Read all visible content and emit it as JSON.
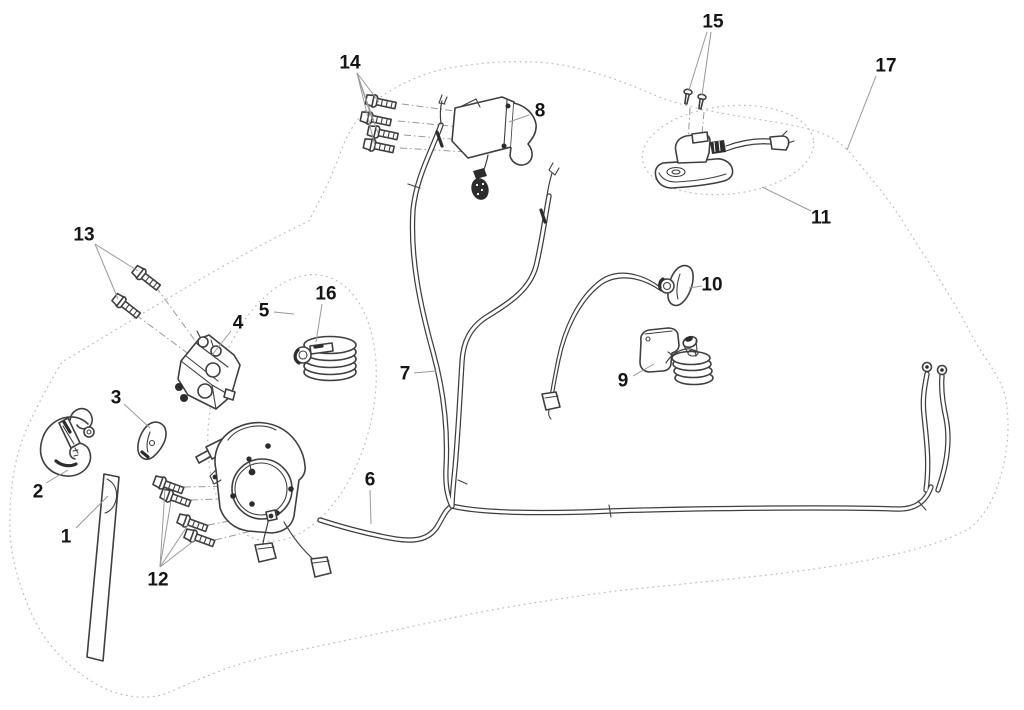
{
  "diagram": {
    "background_color": "#ffffff",
    "line_color": "#3f3f3f",
    "leader_color": "#999999",
    "boundary_color": "#bdbdbd",
    "label_color": "#151515"
  },
  "callouts": [
    {
      "num": "1",
      "part": "strap",
      "x": 66,
      "y": 536,
      "leaders": [
        [
          76,
          528,
          108,
          496
        ]
      ]
    },
    {
      "num": "2",
      "part": "hook",
      "x": 38,
      "y": 491,
      "leaders": [
        [
          46,
          483,
          68,
          470
        ]
      ]
    },
    {
      "num": "3",
      "part": "clip",
      "x": 116,
      "y": 397,
      "leaders": [
        [
          124,
          404,
          150,
          428
        ]
      ]
    },
    {
      "num": "4",
      "part": "relay-box",
      "x": 238,
      "y": 322,
      "leaders": [
        [
          231,
          331,
          212,
          355
        ]
      ]
    },
    {
      "num": "5",
      "part": "coil-group",
      "x": 264,
      "y": 310,
      "leaders": [
        [
          274,
          312,
          294,
          314
        ]
      ]
    },
    {
      "num": "6",
      "part": "wiring-harness",
      "x": 370,
      "y": 479,
      "leaders": [
        [
          370,
          490,
          371,
          524
        ]
      ]
    },
    {
      "num": "7",
      "part": "power-cables",
      "x": 405,
      "y": 373,
      "leaders": [
        [
          414,
          373,
          436,
          371
        ]
      ]
    },
    {
      "num": "8",
      "part": "contactor-switch",
      "x": 540,
      "y": 110,
      "leaders": [
        [
          529,
          115,
          509,
          122
        ]
      ]
    },
    {
      "num": "9",
      "part": "wire-bracket",
      "x": 623,
      "y": 380,
      "leaders": [
        [
          633,
          376,
          654,
          364
        ]
      ]
    },
    {
      "num": "10",
      "part": "lever-switch",
      "x": 712,
      "y": 284,
      "leaders": [
        [
          702,
          286,
          689,
          288
        ]
      ]
    },
    {
      "num": "11",
      "part": "switch-assembly",
      "x": 821,
      "y": 217,
      "leaders": [
        [
          811,
          211,
          762,
          187
        ]
      ]
    },
    {
      "num": "12",
      "part": "motor-bolts",
      "x": 158,
      "y": 579,
      "leaders": [
        [
          160,
          567,
          165,
          489
        ],
        [
          160,
          567,
          171,
          501
        ],
        [
          160,
          567,
          188,
          525
        ],
        [
          160,
          567,
          195,
          540
        ]
      ]
    },
    {
      "num": "13",
      "part": "relay-bolts",
      "x": 84,
      "y": 234,
      "leaders": [
        [
          95,
          244,
          138,
          271
        ],
        [
          95,
          244,
          118,
          299
        ]
      ]
    },
    {
      "num": "14",
      "part": "contactor-bolts",
      "x": 350,
      "y": 62,
      "leaders": [
        [
          357,
          73,
          379,
          102
        ],
        [
          357,
          73,
          372,
          119
        ],
        [
          357,
          73,
          378,
          133
        ],
        [
          357,
          73,
          375,
          146
        ]
      ]
    },
    {
      "num": "15",
      "part": "screws",
      "x": 713,
      "y": 21,
      "leaders": [
        [
          707,
          32,
          689,
          90
        ],
        [
          711,
          32,
          702,
          95
        ]
      ]
    },
    {
      "num": "16",
      "part": "coiled-cable",
      "x": 326,
      "y": 293,
      "leaders": [
        [
          322,
          304,
          316,
          342
        ]
      ]
    },
    {
      "num": "17",
      "part": "outline-boundary",
      "x": 886,
      "y": 65,
      "leaders": [
        [
          876,
          76,
          847,
          150
        ]
      ]
    }
  ]
}
